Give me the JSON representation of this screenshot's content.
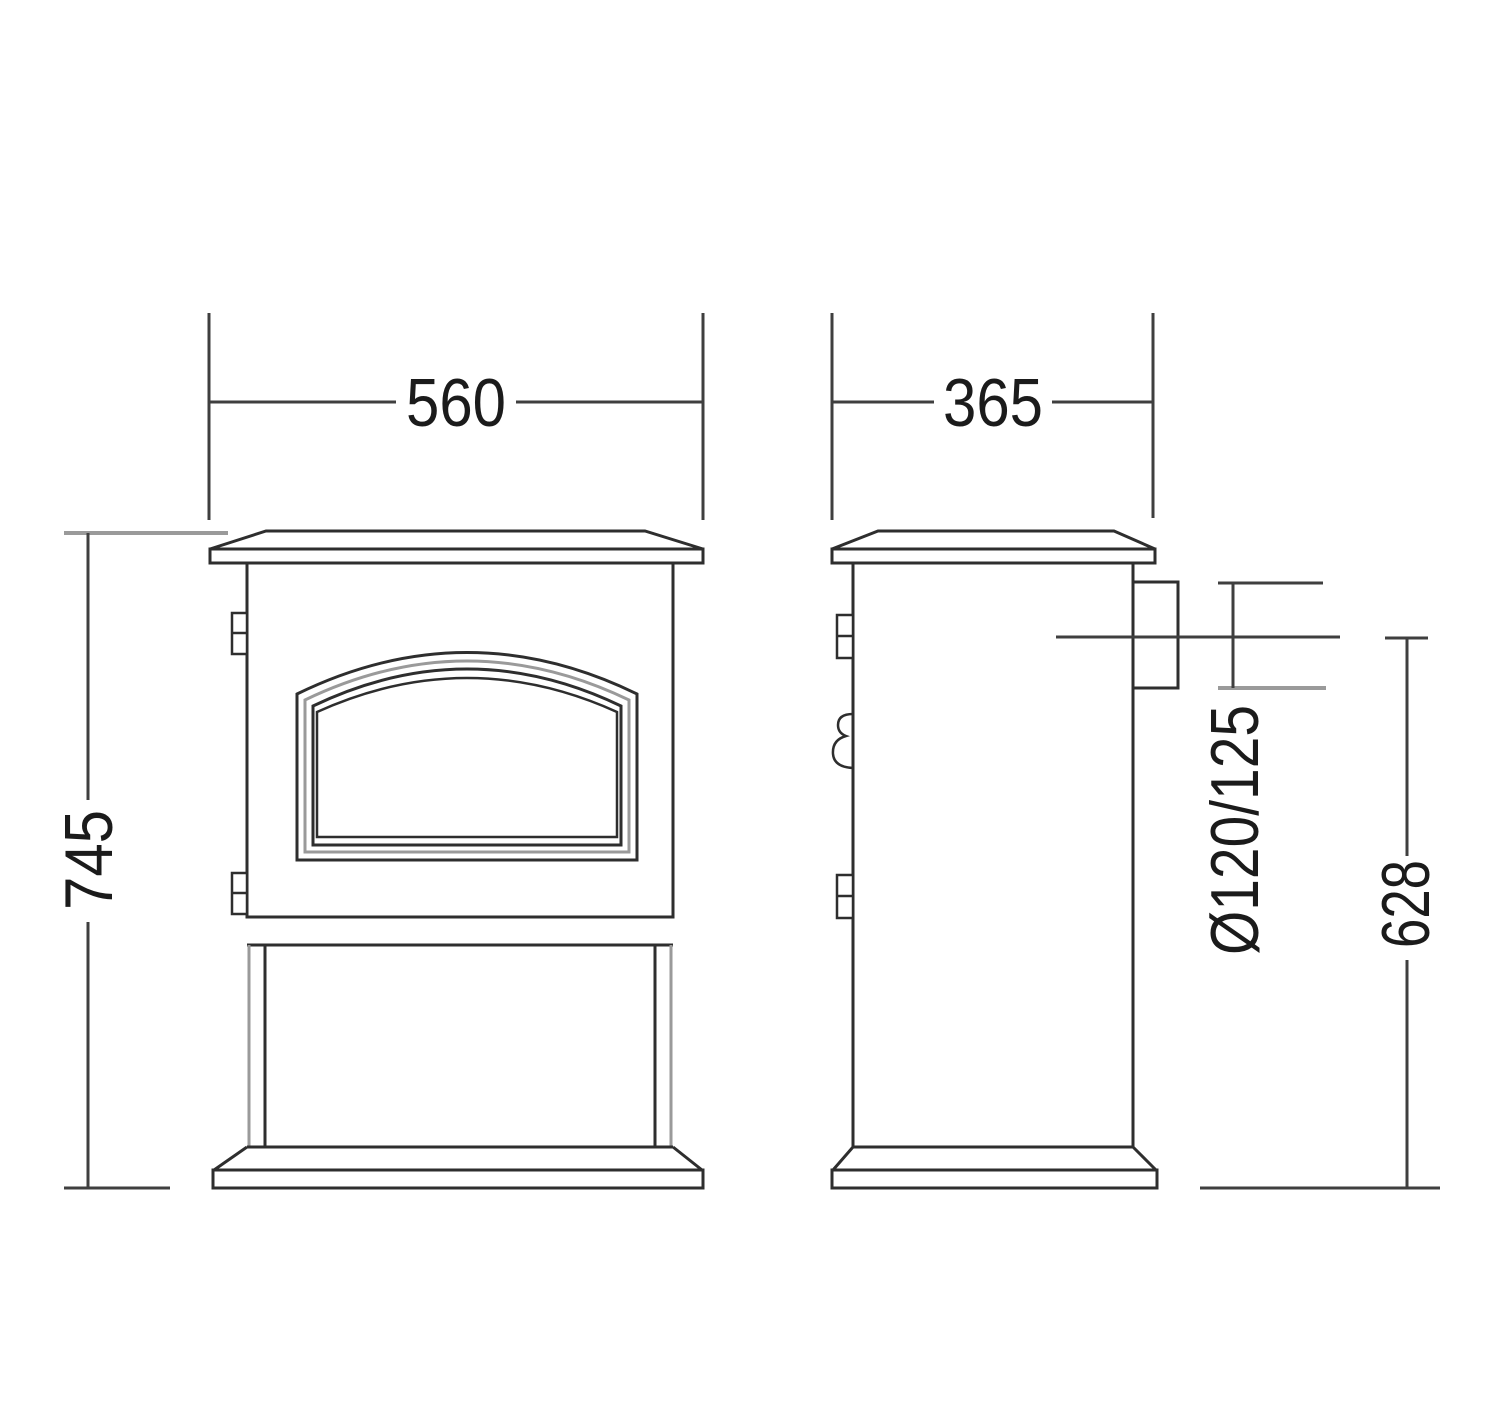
{
  "page": {
    "kind": "technical-dimension-drawing",
    "background": "#ffffff"
  },
  "drawing": {
    "subject": "Freestanding stove — front and side elevations with dimensions (mm)",
    "views": {
      "front": "front-elevation",
      "side": "side-elevation"
    },
    "dimensions": {
      "front_width": {
        "value": "560"
      },
      "side_depth": {
        "value": "365"
      },
      "overall_height": {
        "value": "745"
      },
      "flue_diameter": {
        "value": "Ø120/125"
      },
      "flue_centre_height": {
        "value": "628"
      }
    },
    "colors": {
      "line_dark": "#2e2e2e",
      "line_gray": "#9a9a9a",
      "dimension_line": "#3f3f3f",
      "text": "#1b1b1b",
      "background": "#ffffff"
    }
  }
}
